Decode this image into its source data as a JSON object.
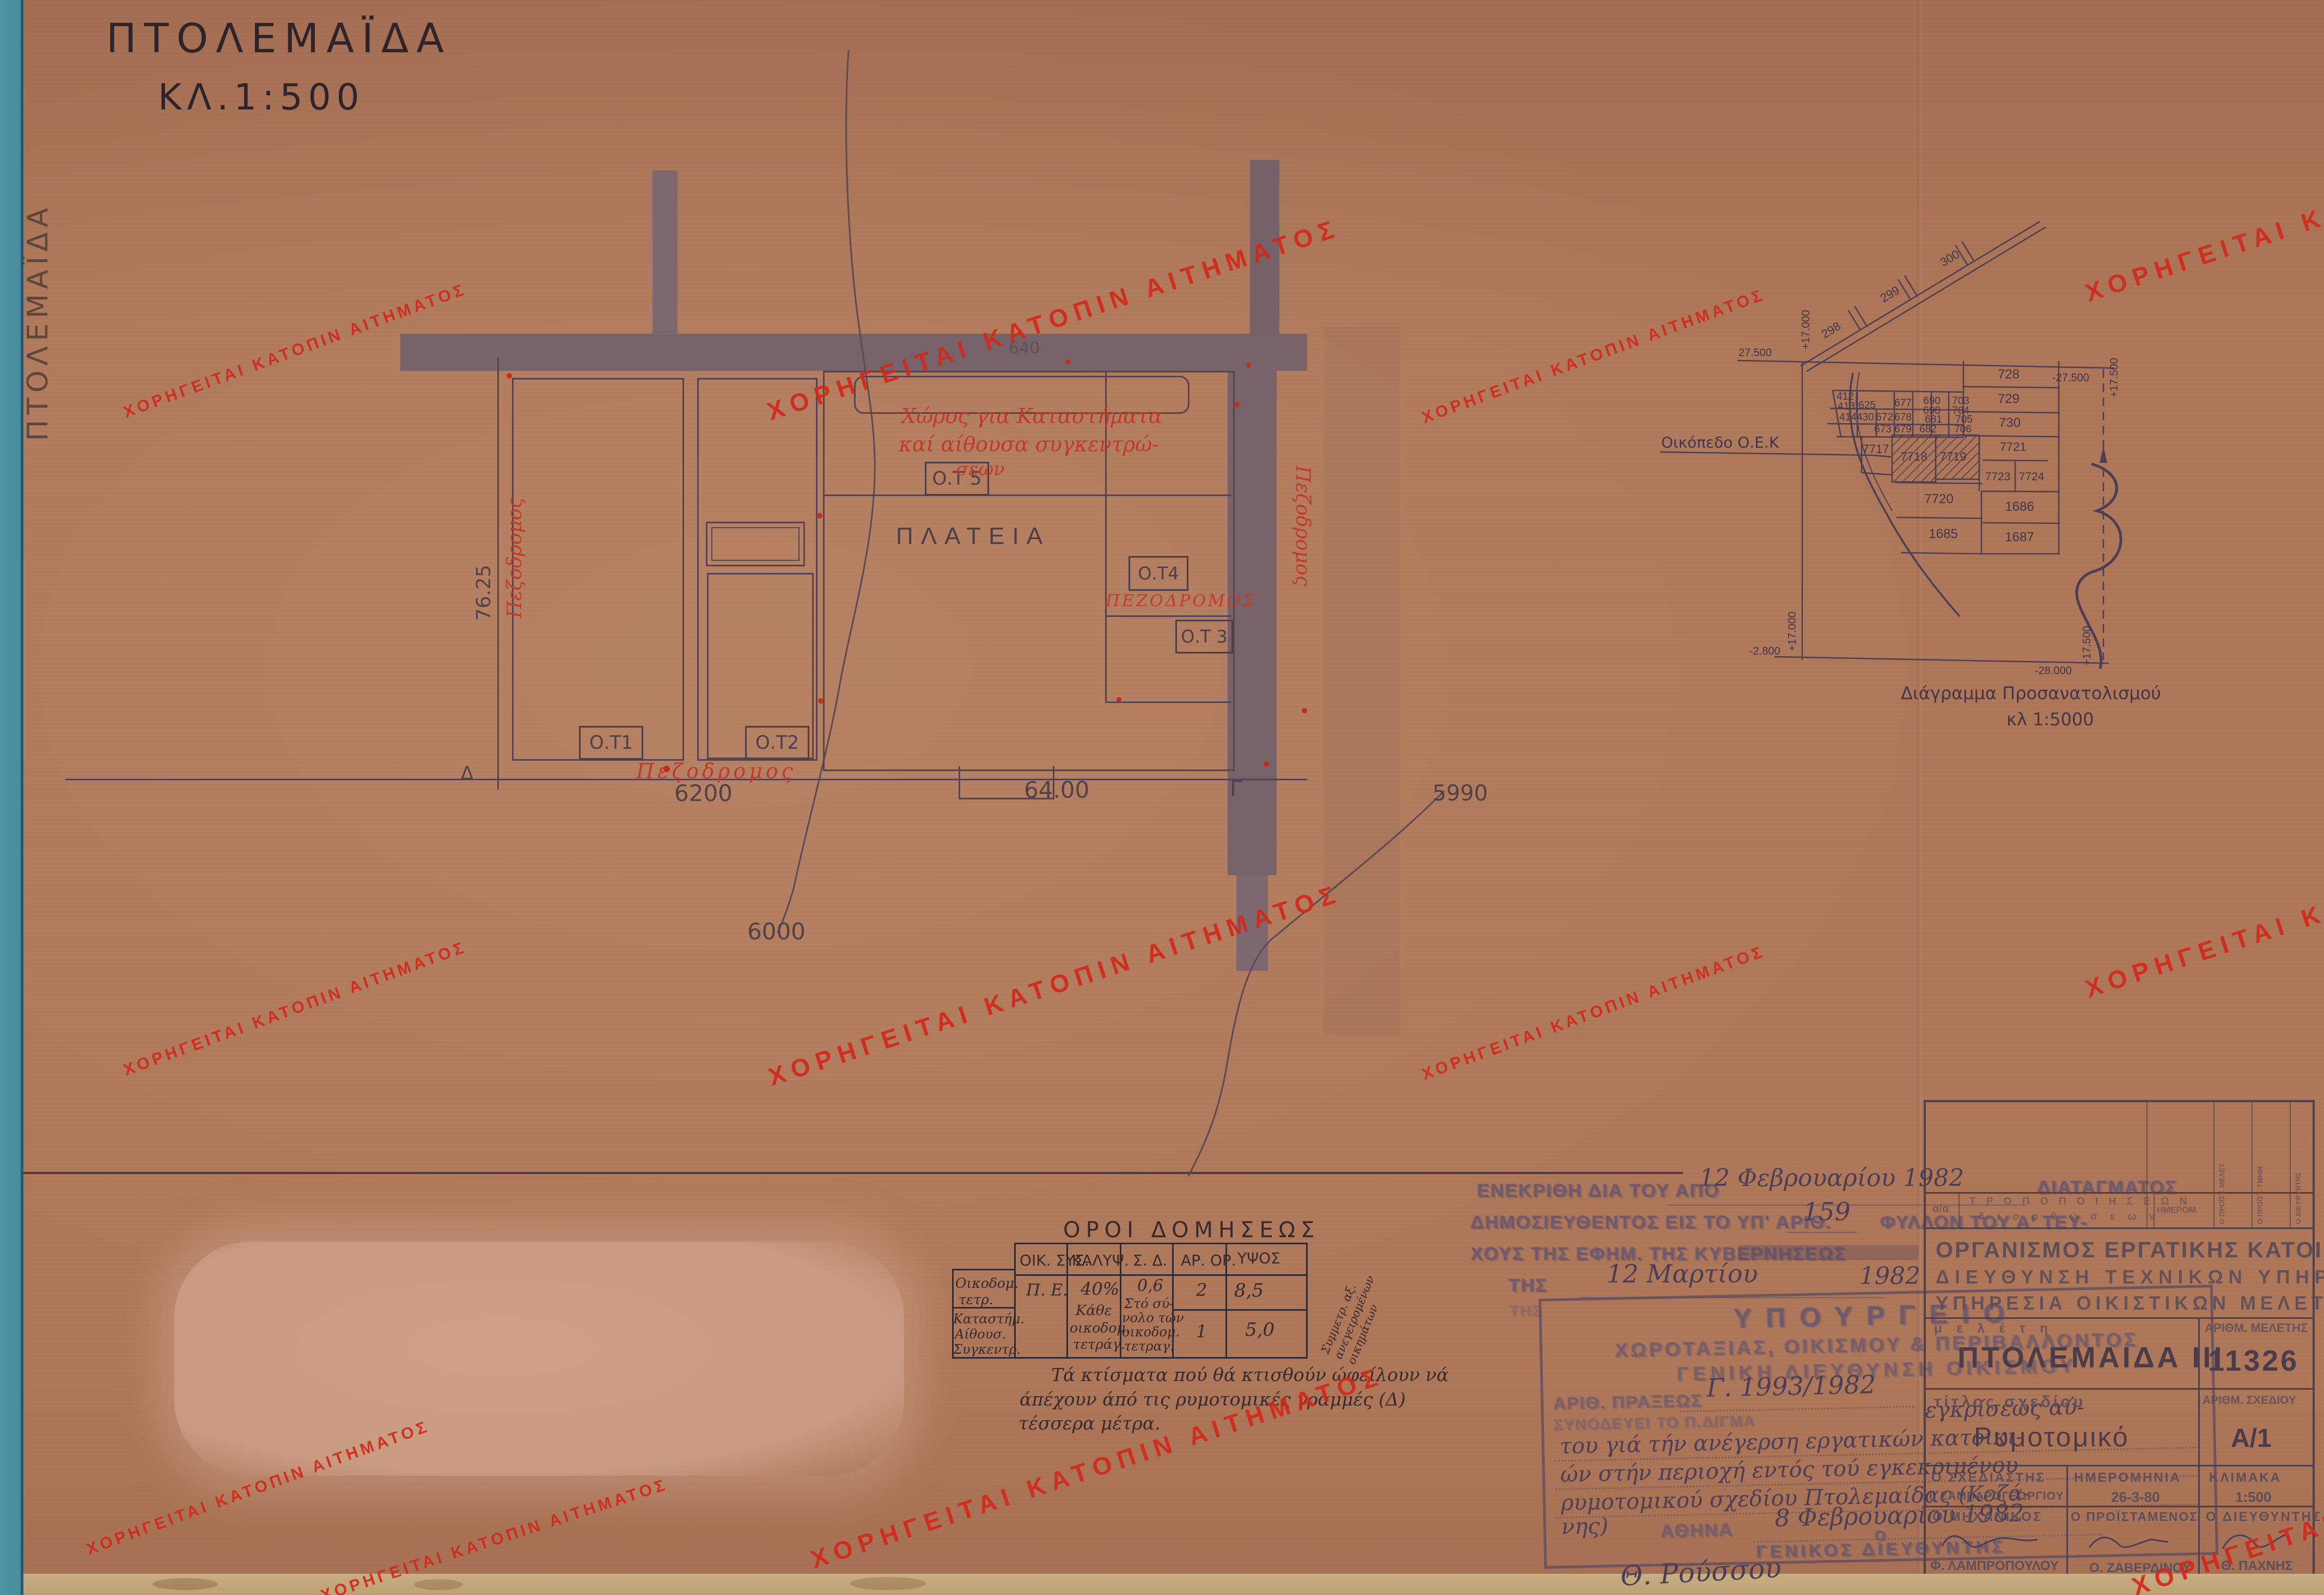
{
  "page": {
    "title": "ΠΤΟΛΕΜΑΪΔΑ",
    "scale": "ΚΛ.1:500",
    "margin_note": "ΠΤΟΛΕΜΑΪΔΑ"
  },
  "watermark": {
    "text": "ΧΟΡΗΓΕΙΤΑΙ ΚΑΤΟΠΙΝ ΑΙΤΗΜΑΤΟΣ"
  },
  "plan": {
    "ot1": "Ο.Τ1",
    "ot2": "Ο.Τ2",
    "ot3": "Ο.Τ 3",
    "ot4": "Ο.Τ4",
    "ot5": "Ο.Τ 5",
    "plateia": "ΠΛΑΤΕΙΑ",
    "red_note1": "Χώρος για Καταστήματα",
    "red_note2": "καί αίθουσα συγκεντρώ-",
    "red_note3": "σεων",
    "ped_left": "Πεζοδρομος",
    "ped_right": "Πεζοδρομος",
    "ped_bottom": "Πεζοδρομος",
    "ped_ot3": "ΠΕΖΟΔΡΟΜΟΣ",
    "dim_7625": "76.25",
    "dim_6200": "6200",
    "dim_6400": "64.00",
    "dim_5990": "5990",
    "dim_6000": "6000",
    "dim_640": "640",
    "marker_delta": "Δ",
    "marker_gamma": "Γ"
  },
  "orientation": {
    "caption1": "Διάγραμμα Προσανατολισμού",
    "caption2": "κλ 1:5000",
    "oek_label": "Οικόπεδο  Ο.Ε.Κ",
    "roads": [
      "298",
      "299",
      "300"
    ],
    "coords": {
      "c1": "27.500",
      "c2": "+17.000",
      "c3": "-27.500",
      "c4": "+17.500",
      "c5": "-2.800",
      "c6": "+17.000",
      "c7": "-28.000",
      "c8": "+17.500"
    },
    "parcels": [
      "412",
      "413",
      "625",
      "414",
      "430",
      "672",
      "678",
      "673",
      "679",
      "677",
      "690",
      "698",
      "681",
      "682",
      "703",
      "704",
      "705",
      "706",
      "728",
      "729",
      "730",
      "7717",
      "7718",
      "7719",
      "7721",
      "7723",
      "7724",
      "7720",
      "1685",
      "1686",
      "1687"
    ]
  },
  "approval": {
    "line1a": "ΕΝΕΚΡΙΘΗ ΔΙΑ ΤΟΥ ΑΠΟ",
    "hand_date1": "12 Φεβρουαρίου 1982",
    "line1b": "ΔΙΑΤΑΓΜΑΤΟΣ",
    "line2a": "ΔΗΜΟΣΙΕΥΘΕΝΤΟΣ ΕΙΣ ΤΟ ΥΠ' ΑΡΙΘ.",
    "hand_number": "159",
    "line2b": "ΦΥΛΛΟΝ ΤΟΥ Α' ΤΕΥ-",
    "line3": "ΧΟΥΣ ΤΗΣ ΕΦΗΜ. ΤΗΣ ΚΥΒΕΡΝΗΣΕΩΣ",
    "line4": "ΤΗΣ",
    "hand_date2": "12 Μαρτίου",
    "hand_year2": "1982",
    "ghost": "ΤΗΣ"
  },
  "ministry": {
    "l1": "ΥΠΟΥΡΓΕΙΟ",
    "l2": "ΧΩΡΟΤΑΞΙΑΣ, ΟΙΚΙΣΜΟΥ & ΠΕΡΙΒΑΛΛΟΝΤΟΣ",
    "l3": "ΓΕΝΙΚΗ ΔΙΕΥΘΥΝΣΗ ΟΙΚΙΣΜΟΥ",
    "l4": "ΑΡΙΘ. ΠΡΑΞΕΩΣ",
    "hand_praxis": "Γ. 1993/1982",
    "l5": "ΣΥΝΟΔΕΥΕΙ ΤΟ Π.Δ/ΓΜΑ",
    "hand_b1": "εγκρίσεως αύ-",
    "hand_b2": "του γιά τήν ανέγερση εργατικών κατοικι-",
    "hand_b3": "ών στήν περιοχή εντός τού εγκεκριμένου",
    "hand_b4": "ρυμοτομικού σχεδίου Πτολεμαίδας (Κοζά-",
    "hand_b5": "νης)",
    "city": "ΑΘΗΝΑ",
    "hand_city_date": "8 Φεβρουαρίου 1982",
    "sig_o": "Ο",
    "sig_title": "ΓΕΝΙΚΟΣ ΔΙΕΥΘΥΝΤΗΣ",
    "signature": "Θ. Ρούσσου"
  },
  "table": {
    "title": "ΟΡΟΙ ΔΟΜΗΣΕΩΣ",
    "h1": "ΟΙΚ. ΣΥΣ.",
    "h2": "ΚΑΛΥΨ.",
    "h3": "Σ. Δ.",
    "h4": "ΑΡ. ΟΡ.",
    "h5": "ΥΨΟΣ",
    "rh1a": "Οικοδομ.",
    "rh1b": "τετρ.",
    "rh2a": "Καταστήμ.",
    "rh2b": "Αίθουσ.",
    "rh2c": "Συγκεντρ.",
    "c1": "Π. Ε.",
    "c2a": "40%",
    "c2b": "Κάθε",
    "c2c": "οικοδομ.",
    "c2d": "τετράγ.",
    "c3a": "0,6",
    "c3b": "Στό σύ-",
    "c3c": "νολο τών",
    "c3d": "οικοδομ.",
    "c3e": "τετραγ.",
    "r1_floors": "2",
    "r1_height": "8,5",
    "r2_floors": "1",
    "r2_height": "5,0",
    "side_note": "Συμμετρ. αξ. ανεγειρομένων οικημάτων",
    "note1": "Τά κτίσματα πού θά κτισθούν ώφείλουν νά",
    "note2": "άπέχουν άπό τις ρυμοτομικές γραμμές (Δ)",
    "note3": "τέσσερα μέτρα."
  },
  "tblock": {
    "aa": "α/α",
    "mod1": "Τ Ρ Ο Π Ο Π Ο Ι Η Σ Ε Ω Ν",
    "mod2": "δ ι ο ρ θ ώ σ ε ω ν",
    "date_h": "ΗΜΕΡΟΜ.",
    "v1": "Ο ΠΡΟΪΣΤ. ΜΕΛΕΤ.",
    "v2": "Ο ΠΡΟΪΣΤ. ΤΜΗΜ.",
    "v3": "Ο ΔΙΕΥΘΥΝΤΗΣ",
    "org1": "ΟΡΓΑΝΙΣΜΟΣ ΕΡΓΑΤΙΚΗΣ ΚΑΤΟΙΚΙΑΣ",
    "org2": "ΔΙΕΥΘΥΝΣΗ ΤΕΧΝΙΚΩΝ ΥΠΗΡΕΣΙΩΝ",
    "org3": "ΥΠΗΡΕΣΙΑ ΟΙΚΙΣΤΙΚΩΝ ΜΕΛΕΤΩΝ",
    "study_label": "μ ε λ έ τ η",
    "study_no_label": "ΑΡΙΘΜ. ΜΕΛΕΤΗΣ",
    "study_name": "ΠΤΟΛΕΜΑΙΔΑ ΙΙΙ",
    "study_no": "11326",
    "plan_title_label": "τίτλος σχεδίου",
    "plan_no_label": "ΑΡΙΘΜ. ΣΧΕΔΙΟΥ",
    "plan_title": "Ρυμοτομικό",
    "plan_no": "Α/1",
    "designer_label": "Ο ΣΧΕΔΙΑΣΤΗΣ",
    "designer": "Ι. ΖΑΜΠΑΡΟΓΕΩΡΓΙΟΥ",
    "date_label": "ΗΜΕΡΟΜΗΝΙΑ",
    "date": "26-3-80",
    "scale_label": "ΚΛΙΜΑΚΑ",
    "scale": "1:500",
    "engineer_label": "Ο ΜΗΧΑΝΙΚΟΣ",
    "engineer": "Φ. ΛΑΜΠΡΟΠΟΥΛΟΥ",
    "supervisor_label": "Ο ΠΡΟΪΣΤΑΜΕΝΟΣ",
    "supervisor": "Ο. ΖΑΒΕΡΔΙΝΟΥ",
    "director_label": "Ο ΔΙΕΥΘΥΝΤΗΣ",
    "director": "Θ. ΠΑΧΝΗΣ"
  }
}
